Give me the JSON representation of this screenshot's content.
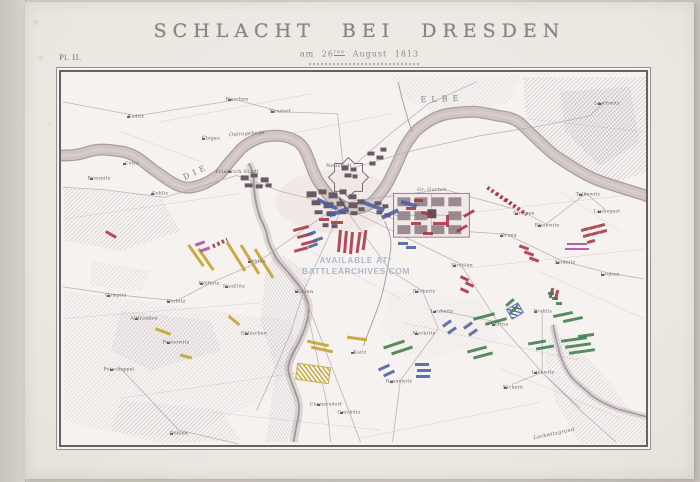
{
  "page": {
    "plate_label": "Pl. II.",
    "title": "SCHLACHT BEI DRESDEN",
    "subtitle": {
      "prefix": "am",
      "day": "26",
      "ordinal": "ten",
      "rest": "August 1813"
    },
    "watermark": {
      "line1": "AVAILABLE AT*",
      "line2": "BATTLEARCHIVES.COM"
    }
  },
  "map": {
    "palette": {
      "red": "#a93342",
      "blue": "#4e5e9e",
      "yellow": "#c3a02c",
      "green": "#3e7d49",
      "magenta": "#a8509a",
      "ink": "#6f6065"
    },
    "labels": [
      {
        "t": "DIE",
        "x": 135,
        "y": 100,
        "s": 8,
        "sp": 4,
        "a": -25,
        "r": 1
      },
      {
        "t": "ELBE",
        "x": 381,
        "y": 27,
        "s": 8,
        "sp": 5,
        "a": -2,
        "r": 1
      },
      {
        "t": "Friedrich Stadt",
        "x": 176,
        "y": 100,
        "s": 5,
        "v": 1
      },
      {
        "t": "Ostragehege",
        "x": 186,
        "y": 62,
        "s": 5,
        "i": 1,
        "a": -4
      },
      {
        "t": "Neustadt",
        "x": 278,
        "y": 94,
        "s": 5
      },
      {
        "t": "Pieschen",
        "x": 176,
        "y": 28,
        "s": 4.5,
        "v": 1
      },
      {
        "t": "Neudorf",
        "x": 219,
        "y": 40,
        "s": 4.5,
        "v": 1
      },
      {
        "t": "Kaditz",
        "x": 75,
        "y": 45,
        "s": 4.5,
        "v": 1
      },
      {
        "t": "Übigau",
        "x": 150,
        "y": 67,
        "s": 4.5,
        "v": 1
      },
      {
        "t": "Cotta",
        "x": 71,
        "y": 92,
        "s": 4.5,
        "v": 1
      },
      {
        "t": "Gohlis",
        "x": 99,
        "y": 122,
        "s": 4.5,
        "v": 1
      },
      {
        "t": "Briesnitz",
        "x": 38,
        "y": 107,
        "s": 4.5,
        "v": 1
      },
      {
        "t": "Löbtau",
        "x": 196,
        "y": 190,
        "s": 4.5,
        "v": 1
      },
      {
        "t": "Plauen",
        "x": 243,
        "y": 220,
        "s": 5,
        "v": 1
      },
      {
        "t": "Gompitz",
        "x": 55,
        "y": 224,
        "s": 4.5,
        "v": 1
      },
      {
        "t": "Gorbitz",
        "x": 115,
        "y": 230,
        "s": 4.5,
        "v": 1
      },
      {
        "t": "Wölfnitz",
        "x": 148,
        "y": 212,
        "s": 4.5,
        "v": 1
      },
      {
        "t": "Naußlitz",
        "x": 173,
        "y": 215,
        "s": 4.5,
        "v": 1
      },
      {
        "t": "Altfranken",
        "x": 83,
        "y": 247,
        "s": 4.5,
        "v": 1
      },
      {
        "t": "Pesterwitz",
        "x": 115,
        "y": 271,
        "s": 4.5,
        "v": 1
      },
      {
        "t": "Potschappel",
        "x": 58,
        "y": 298,
        "s": 4.5,
        "v": 1
      },
      {
        "t": "Döhlen",
        "x": 118,
        "y": 362,
        "s": 4.5,
        "v": 1
      },
      {
        "t": "Dölzschen",
        "x": 193,
        "y": 262,
        "s": 4.5,
        "v": 1
      },
      {
        "t": "Coschütz",
        "x": 288,
        "y": 341,
        "s": 4.5,
        "v": 1
      },
      {
        "t": "Kaitz",
        "x": 299,
        "y": 281,
        "s": 4.5,
        "v": 1
      },
      {
        "t": "Cunnersdorf",
        "x": 265,
        "y": 333,
        "s": 4.5,
        "v": 1
      },
      {
        "t": "Bannewitz",
        "x": 338,
        "y": 310,
        "s": 4.5,
        "v": 1
      },
      {
        "t": "Räcknitz",
        "x": 363,
        "y": 220,
        "s": 4.5,
        "v": 1
      },
      {
        "t": "Mockritz",
        "x": 363,
        "y": 262,
        "s": 4.5,
        "v": 1
      },
      {
        "t": "Strehlen",
        "x": 401,
        "y": 194,
        "s": 4.5,
        "v": 1
      },
      {
        "t": "Leubnitz",
        "x": 381,
        "y": 240,
        "s": 4.5,
        "v": 1
      },
      {
        "t": "Torna",
        "x": 440,
        "y": 253,
        "s": 4.5,
        "v": 1
      },
      {
        "t": "Prohlis",
        "x": 482,
        "y": 240,
        "s": 4.5,
        "v": 1
      },
      {
        "t": "Lockwitz",
        "x": 482,
        "y": 301,
        "s": 4.5,
        "v": 1
      },
      {
        "t": "Nickern",
        "x": 452,
        "y": 316,
        "s": 4.5,
        "v": 1
      },
      {
        "t": "Leuben",
        "x": 549,
        "y": 203,
        "s": 4.5,
        "v": 1
      },
      {
        "t": "Laubegast",
        "x": 546,
        "y": 140,
        "s": 4.5,
        "v": 1
      },
      {
        "t": "Tolkewitz",
        "x": 527,
        "y": 123,
        "s": 4.5,
        "v": 1
      },
      {
        "t": "Blasewitz",
        "x": 486,
        "y": 154,
        "s": 4.5,
        "v": 1
      },
      {
        "t": "Striesen",
        "x": 463,
        "y": 142,
        "s": 4.5,
        "v": 1
      },
      {
        "t": "Gruna",
        "x": 448,
        "y": 164,
        "s": 4.5,
        "v": 1
      },
      {
        "t": "Seidnitz",
        "x": 504,
        "y": 191,
        "s": 4.5,
        "v": 1
      },
      {
        "t": "Loschwitz",
        "x": 546,
        "y": 32,
        "s": 4.5,
        "v": 1
      },
      {
        "t": "Gr. Garten",
        "x": 371,
        "y": 118,
        "s": 5,
        "i": 1
      },
      {
        "t": "Lockwitzgrund",
        "x": 493,
        "y": 362,
        "s": 5,
        "i": 1,
        "a": -12
      }
    ],
    "units": [
      [
        232,
        155,
        16,
        3,
        -15,
        "red"
      ],
      [
        236,
        162,
        16,
        3,
        -15,
        "red"
      ],
      [
        240,
        169,
        16,
        3,
        -15,
        "red"
      ],
      [
        233,
        176,
        14,
        3,
        -15,
        "red"
      ],
      [
        277,
        158,
        3,
        22,
        5,
        "red"
      ],
      [
        283,
        159,
        3,
        22,
        5,
        "red"
      ],
      [
        289,
        160,
        3,
        22,
        5,
        "red"
      ],
      [
        296,
        160,
        3,
        21,
        8,
        "red"
      ],
      [
        302,
        158,
        3,
        20,
        8,
        "red"
      ],
      [
        270,
        149,
        12,
        3,
        0,
        "red"
      ],
      [
        258,
        146,
        10,
        3,
        0,
        "red"
      ],
      [
        345,
        135,
        10,
        3,
        0,
        "red"
      ],
      [
        360,
        140,
        12,
        3,
        10,
        "red"
      ],
      [
        350,
        150,
        10,
        3,
        0,
        "red"
      ],
      [
        372,
        150,
        14,
        3,
        0,
        "red"
      ],
      [
        362,
        160,
        10,
        3,
        0,
        "red"
      ],
      [
        385,
        143,
        3,
        12,
        0,
        "red"
      ],
      [
        395,
        155,
        12,
        3,
        -30,
        "red"
      ],
      [
        402,
        140,
        12,
        3,
        -30,
        "red"
      ],
      [
        353,
        127,
        9,
        3,
        0,
        "red"
      ],
      [
        424,
        121,
        26,
        4,
        35,
        "red",
        "striped"
      ],
      [
        433,
        127,
        26,
        4,
        35,
        "red",
        "striped"
      ],
      [
        442,
        133,
        26,
        4,
        35,
        "red",
        "striped"
      ],
      [
        151,
        169,
        16,
        4,
        -25,
        "red",
        "striped"
      ],
      [
        458,
        174,
        10,
        3,
        20,
        "red"
      ],
      [
        463,
        180,
        10,
        3,
        20,
        "red"
      ],
      [
        468,
        186,
        10,
        3,
        20,
        "red"
      ],
      [
        520,
        156,
        8,
        3,
        -15,
        "red"
      ],
      [
        528,
        154,
        8,
        3,
        -15,
        "red"
      ],
      [
        536,
        152,
        8,
        3,
        -15,
        "red"
      ],
      [
        522,
        162,
        8,
        3,
        -15,
        "red"
      ],
      [
        530,
        160,
        8,
        3,
        -15,
        "red"
      ],
      [
        538,
        158,
        8,
        3,
        -15,
        "red"
      ],
      [
        526,
        168,
        8,
        3,
        -15,
        "red"
      ],
      [
        44,
        161,
        12,
        3,
        30,
        "red"
      ],
      [
        489,
        216,
        3,
        10,
        15,
        "red"
      ],
      [
        494,
        218,
        3,
        10,
        15,
        "red"
      ],
      [
        399,
        205,
        9,
        3,
        25,
        "red"
      ],
      [
        404,
        211,
        9,
        3,
        25,
        "red"
      ],
      [
        399,
        217,
        9,
        3,
        25,
        "red"
      ],
      [
        245,
        160,
        10,
        3,
        -20,
        "blue"
      ],
      [
        252,
        166,
        10,
        3,
        -20,
        "blue"
      ],
      [
        247,
        172,
        10,
        3,
        -20,
        "blue"
      ],
      [
        337,
        170,
        10,
        3,
        0,
        "blue"
      ],
      [
        345,
        174,
        10,
        3,
        0,
        "blue"
      ],
      [
        317,
        294,
        12,
        3,
        -25,
        "blue"
      ],
      [
        322,
        300,
        12,
        3,
        -25,
        "blue"
      ],
      [
        354,
        291,
        14,
        3,
        0,
        "blue"
      ],
      [
        356,
        297,
        14,
        3,
        0,
        "blue"
      ],
      [
        355,
        303,
        14,
        3,
        0,
        "blue"
      ],
      [
        381,
        250,
        10,
        3,
        -35,
        "blue"
      ],
      [
        386,
        257,
        10,
        3,
        -35,
        "blue"
      ],
      [
        402,
        252,
        10,
        3,
        -35,
        "blue"
      ],
      [
        407,
        259,
        10,
        3,
        -35,
        "blue"
      ],
      [
        255,
        130,
        22,
        4,
        25,
        "blue"
      ],
      [
        268,
        138,
        20,
        4,
        -20,
        "blue"
      ],
      [
        300,
        132,
        24,
        4,
        20,
        "blue"
      ],
      [
        320,
        140,
        18,
        4,
        -25,
        "blue"
      ],
      [
        340,
        130,
        16,
        4,
        15,
        "blue"
      ],
      [
        448,
        234,
        12,
        10,
        -30,
        "blue",
        "hatch"
      ],
      [
        122,
        182,
        26,
        3,
        55,
        "yellow"
      ],
      [
        132,
        186,
        26,
        3,
        55,
        "yellow"
      ],
      [
        158,
        183,
        34,
        3,
        58,
        "yellow"
      ],
      [
        172,
        186,
        34,
        3,
        58,
        "yellow"
      ],
      [
        186,
        190,
        34,
        3,
        58,
        "yellow"
      ],
      [
        166,
        247,
        14,
        3,
        40,
        "yellow"
      ],
      [
        246,
        270,
        22,
        3,
        12,
        "yellow"
      ],
      [
        250,
        276,
        22,
        3,
        12,
        "yellow"
      ],
      [
        286,
        265,
        20,
        3,
        8,
        "yellow"
      ],
      [
        236,
        294,
        32,
        15,
        8,
        "yellow",
        "hatch"
      ],
      [
        94,
        258,
        16,
        3,
        20,
        "yellow"
      ],
      [
        119,
        283,
        12,
        3,
        15,
        "yellow"
      ],
      [
        412,
        243,
        22,
        3,
        -15,
        "green"
      ],
      [
        424,
        248,
        22,
        3,
        -15,
        "green"
      ],
      [
        492,
        241,
        20,
        3,
        -12,
        "green"
      ],
      [
        502,
        246,
        20,
        3,
        -12,
        "green"
      ],
      [
        467,
        269,
        18,
        3,
        -10,
        "green"
      ],
      [
        475,
        274,
        18,
        3,
        -10,
        "green"
      ],
      [
        500,
        266,
        26,
        3,
        -8,
        "green"
      ],
      [
        504,
        272,
        26,
        3,
        -8,
        "green"
      ],
      [
        508,
        278,
        26,
        3,
        -8,
        "green"
      ],
      [
        487,
        220,
        6,
        3,
        0,
        "green"
      ],
      [
        491,
        225,
        6,
        3,
        0,
        "green"
      ],
      [
        495,
        230,
        6,
        3,
        0,
        "green"
      ],
      [
        322,
        271,
        22,
        3,
        -18,
        "green"
      ],
      [
        330,
        277,
        22,
        3,
        -18,
        "green"
      ],
      [
        406,
        276,
        20,
        3,
        -15,
        "green"
      ],
      [
        412,
        282,
        20,
        3,
        -15,
        "green"
      ],
      [
        444,
        229,
        10,
        3,
        -40,
        "green"
      ],
      [
        448,
        236,
        10,
        3,
        -40,
        "green"
      ],
      [
        517,
        262,
        16,
        3,
        -8,
        "green"
      ],
      [
        134,
        170,
        10,
        3,
        -20,
        "magenta"
      ],
      [
        139,
        176,
        10,
        3,
        -20,
        "magenta"
      ],
      [
        506,
        171,
        20,
        2,
        0,
        "magenta"
      ],
      [
        504,
        176,
        24,
        2,
        0,
        "magenta"
      ]
    ]
  }
}
